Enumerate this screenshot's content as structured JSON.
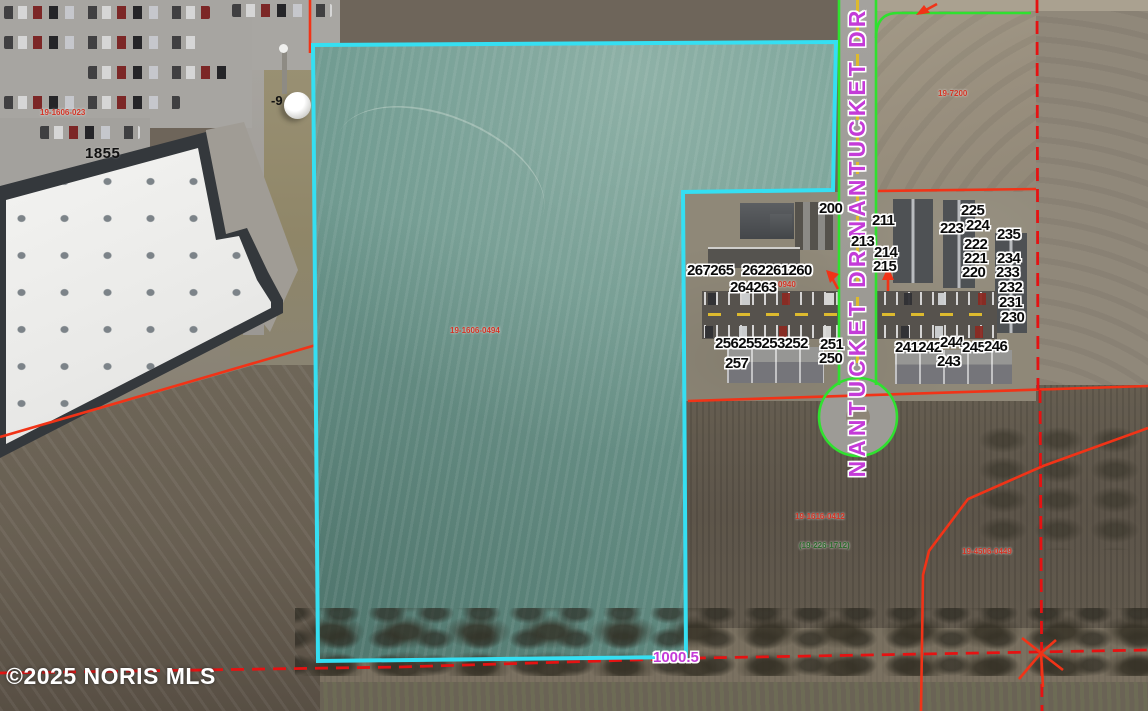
{
  "street": {
    "top": "NANTUCKET DR",
    "bottom": "NANTUCKET DR"
  },
  "labels": {
    "building_number": "1855",
    "elevation_marker": "-9",
    "distance": "1000.5",
    "copyright": "©2025 NORIS MLS"
  },
  "lots": {
    "n200": "200",
    "n211": "211",
    "n213": "213",
    "n214": "214",
    "n215": "215",
    "n225": "225",
    "n223": "223",
    "n224": "224",
    "n235": "235",
    "n222": "222",
    "n221": "221",
    "n234": "234",
    "n220": "220",
    "n233": "233",
    "n232": "232",
    "n231": "231",
    "n230": "230",
    "g267_265": "267265",
    "g262_261_260": "262261260",
    "g264_263": "264263",
    "g256_255_253_252": "256255253252",
    "n251": "251",
    "n250": "250",
    "n257": "257",
    "g241_242": "241242",
    "n244": "244",
    "n245": "245",
    "n246": "246",
    "n243": "243"
  },
  "parcel_ids": {
    "warehouse": "19-1606-023",
    "field_center": "19-1606-0494",
    "north_field": "19-7200",
    "south_1": "19-1616-0412",
    "south_2": "(19-226-1712)",
    "south_3": "19-4506-0449",
    "dev_small": "0940"
  },
  "colors": {
    "cyan": "#35dff2",
    "green": "#2fe12f",
    "red": "#f13317",
    "red2": "#e51212",
    "magenta": "#c43bd8"
  }
}
